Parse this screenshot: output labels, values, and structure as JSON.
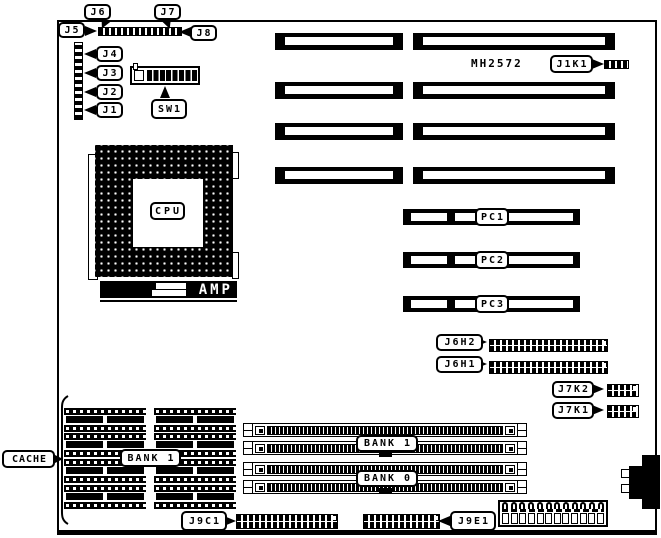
{
  "diagram": {
    "type": "motherboard-layout",
    "colors": {
      "line": "#000000",
      "background": "#ffffff"
    },
    "labels": {
      "j1": "J1",
      "j2": "J2",
      "j3": "J3",
      "j4": "J4",
      "j5": "J5",
      "j6": "J6",
      "j7": "J7",
      "j8": "J8",
      "sw1": "SW1",
      "cpu": "CPU",
      "amp": "AMP",
      "mh2572": "MH2572",
      "j1k1": "J1K1",
      "pc1": "PC1",
      "pc2": "PC2",
      "pc3": "PC3",
      "j6h2": "J6H2",
      "j6h1": "J6H1",
      "j7k2": "J7K2",
      "j7k1": "J7K1",
      "cache": "CACHE",
      "cache_bank": "BANK 1",
      "bank1": "BANK 1",
      "bank0": "BANK 0",
      "j9c1": "J9C1",
      "j9e1": "J9E1"
    }
  }
}
